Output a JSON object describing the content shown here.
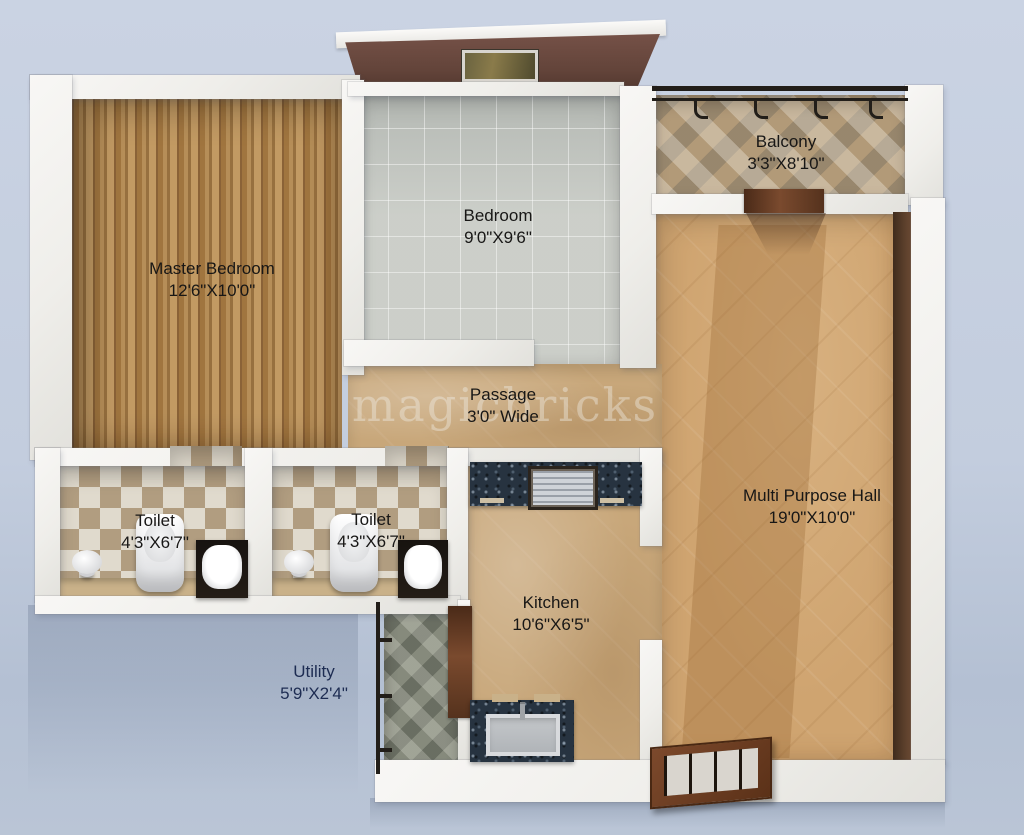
{
  "plan": {
    "watermark": "magicbricks",
    "rooms": {
      "master_bedroom": {
        "label": "Master Bedroom",
        "dims": "12'6\"X10'0\""
      },
      "bedroom": {
        "label": "Bedroom",
        "dims": "9'0\"X9'6\""
      },
      "balcony": {
        "label": "Balcony",
        "dims": "3'3\"X8'10\""
      },
      "passage": {
        "label": "Passage",
        "dims": "3'0\" Wide"
      },
      "toilet1": {
        "label": "Toilet",
        "dims": "4'3\"X6'7\""
      },
      "toilet2": {
        "label": "Toilet",
        "dims": "4'3\"X6'7\""
      },
      "kitchen": {
        "label": "Kitchen",
        "dims": "10'6\"X6'5\""
      },
      "hall": {
        "label": "Multi Purpose Hall",
        "dims": "19'0\"X10'0\""
      },
      "utility": {
        "label": "Utility",
        "dims": "5'9\"X2'4\""
      }
    },
    "colors": {
      "background": "#c3cdde",
      "wall": "#f3f2ef",
      "wood_floor": "#a87f4c",
      "bedroom_tile": "#c9ccc6",
      "marble_beige": "#c8a77a",
      "hall_tan": "#cfa470",
      "toilet_checker": "#b19d80",
      "utility_tile": "#868a7c",
      "granite_counter": "#273340",
      "door_brown": "#6b3a22",
      "canopy_brown": "#6f4c3e",
      "utility_label_text": "#1d2c52",
      "label_text": "#181716"
    }
  }
}
